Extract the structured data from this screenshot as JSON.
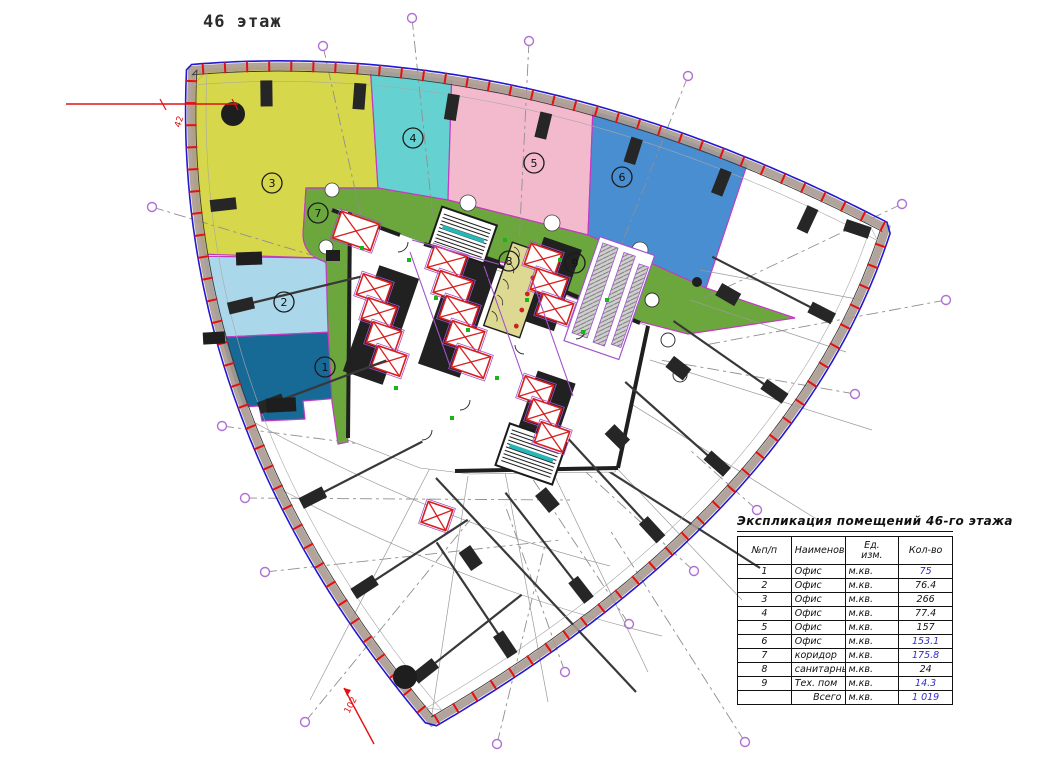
{
  "title": "46 этаж",
  "plan": {
    "zones": [
      {
        "num": "1",
        "name": "Офис",
        "color": "#176996",
        "x": 325,
        "y": 367
      },
      {
        "num": "2",
        "name": "Офис",
        "color": "#abd7eb",
        "x": 284,
        "y": 302
      },
      {
        "num": "3",
        "name": "Офис",
        "color": "#d6d74b",
        "x": 272,
        "y": 183
      },
      {
        "num": "4",
        "name": "Офис",
        "color": "#66d1d1",
        "x": 413,
        "y": 138
      },
      {
        "num": "5",
        "name": "Офис",
        "color": "#f3bacd",
        "x": 534,
        "y": 163
      },
      {
        "num": "6",
        "name": "Офис",
        "color": "#4a8ed2",
        "x": 622,
        "y": 177
      },
      {
        "num": "7",
        "name": "коридор",
        "color": "#6ca73d",
        "x": 318,
        "y": 213
      },
      {
        "num": "8",
        "name": "санитарный узел",
        "color": "#ddd892",
        "x": 509,
        "y": 261
      },
      {
        "num": "9",
        "name": "Тех. пом",
        "color": "",
        "x": 575,
        "y": 263
      }
    ],
    "annotations": {
      "left_mark": "42",
      "bottom_mark": "102"
    }
  },
  "colors": {
    "facade_band": "#ab9a90",
    "facade_tick": "#e31212",
    "facade_outer": "#2118cf",
    "zone_border": "#c23ac2",
    "grid_marker": "#b06fd4",
    "accent_value": "#2b2bd0"
  },
  "table": {
    "title": "Экспликация помещений 46-го этажа",
    "headers": {
      "num": "№п/п",
      "name": "Наименование",
      "unit_line1": "Ед.",
      "unit_line2": "изм.",
      "qty": "Кол-во"
    },
    "rows": [
      {
        "num": "1",
        "name": "Офис",
        "unit": "м.кв.",
        "qty": "75",
        "accent": true
      },
      {
        "num": "2",
        "name": "Офис",
        "unit": "м.кв.",
        "qty": "76.4",
        "accent": false
      },
      {
        "num": "3",
        "name": "Офис",
        "unit": "м.кв.",
        "qty": "266",
        "accent": false
      },
      {
        "num": "4",
        "name": "Офис",
        "unit": "м.кв.",
        "qty": "77.4",
        "accent": false
      },
      {
        "num": "5",
        "name": "Офис",
        "unit": "м.кв.",
        "qty": "157",
        "accent": false
      },
      {
        "num": "6",
        "name": "Офис",
        "unit": "м.кв.",
        "qty": "153.1",
        "accent": true
      },
      {
        "num": "7",
        "name": "коридор",
        "unit": "м.кв.",
        "qty": "175.8",
        "accent": true
      },
      {
        "num": "8",
        "name": "санитарный узел",
        "unit": "м.кв.",
        "qty": "24",
        "accent": false
      },
      {
        "num": "9",
        "name": "Тех. пом",
        "unit": "м.кв.",
        "qty": "14.3",
        "accent": true
      }
    ],
    "total": {
      "label": "Всего",
      "unit": "м.кв.",
      "qty": "1 019",
      "accent": true
    }
  }
}
